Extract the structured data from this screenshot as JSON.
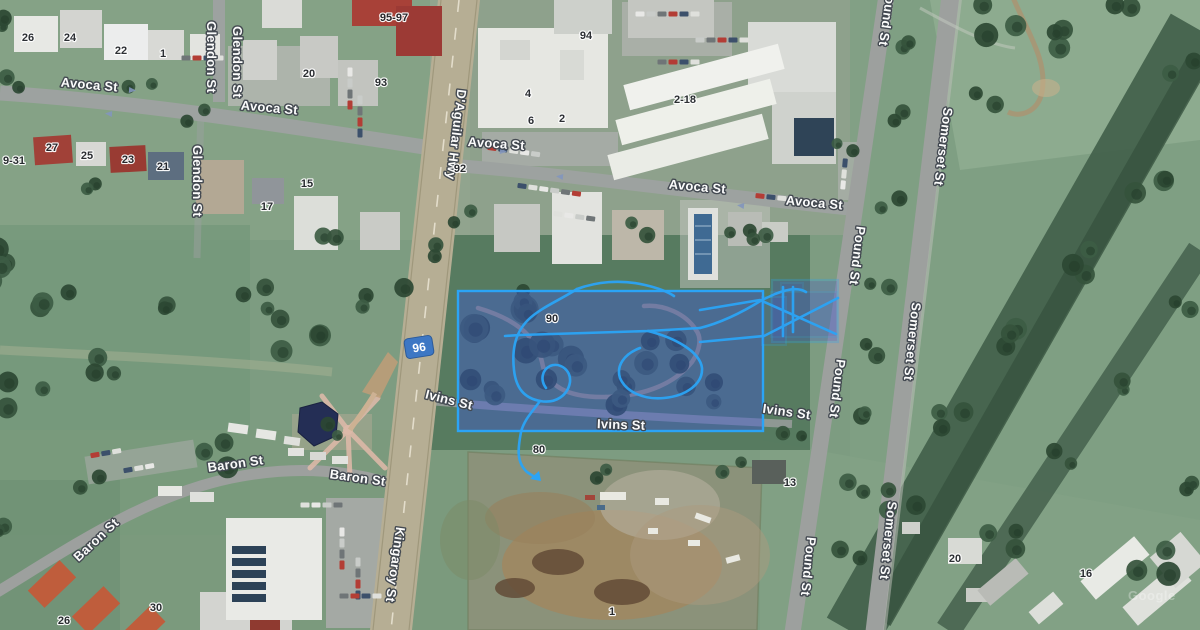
{
  "map": {
    "provider_watermark": "Google",
    "route_shield": "96",
    "streets": [
      "Glendon St",
      "Glendon St",
      "Avoca St",
      "Avoca St",
      "Avoca St",
      "Avoca St",
      "Avoca St",
      "D'Aguilar Hwy",
      "Glendon St",
      "Pound St",
      "Pound St",
      "Pound St",
      "Pound St",
      "Somerset St",
      "Somerset St",
      "Somerset St",
      "Ivins St",
      "Ivins St",
      "Ivins St",
      "Baron St",
      "Baron St",
      "Baron St",
      "Kingaroy St"
    ],
    "addresses": [
      "26",
      "24",
      "22",
      "1",
      "95-97",
      "20",
      "93",
      "94",
      "4",
      "6",
      "2",
      "2-18",
      "9-31",
      "27",
      "25",
      "23",
      "21",
      "15",
      "17",
      "92",
      "90",
      "80",
      "13",
      "30",
      "26",
      "1",
      "20",
      "16"
    ],
    "overlay": {
      "type": "selection-and-gps-track",
      "accent_color": "#2ba4f6",
      "fill_color": "#3c55d6"
    }
  }
}
